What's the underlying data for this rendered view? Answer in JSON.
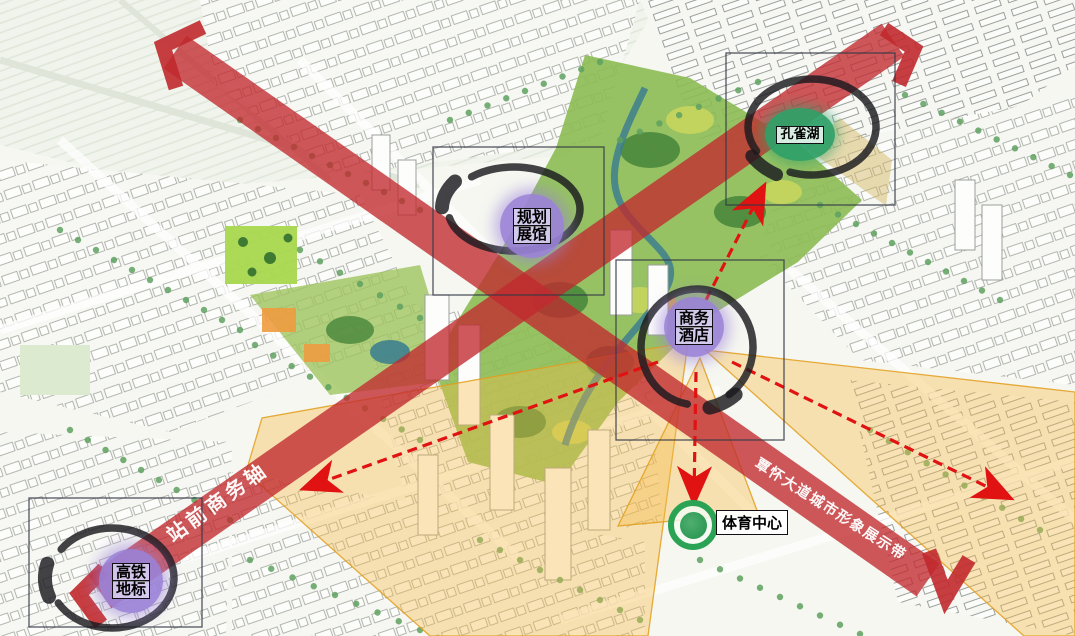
{
  "page": {
    "type": "urban-planning-axis-analysis-map"
  },
  "axes": {
    "business_axis_label": "站前商务轴",
    "display_belt_label": "覃怀大道城市形象展示带"
  },
  "nodes": {
    "peacock_lake": {
      "label": "孔雀湖"
    },
    "planning_hall": {
      "line1": "规划",
      "line2": "展馆"
    },
    "business_hotel": {
      "line1": "商务",
      "line2": "酒店"
    },
    "hsr_landmark": {
      "line1": "高铁",
      "line2": "地标"
    },
    "sports_center": {
      "label": "体育中心"
    }
  },
  "colors": {
    "axis_red": "#c1292e",
    "dashed_arrow_red": "#e01212",
    "view_cone_yellow": "#f5ba46",
    "cone_border": "#e29e1c",
    "badge_purple": "#9a82d8",
    "badge_green": "#2fa068",
    "sports_ring_green": "#2aa355",
    "swoosh_black": "#1a1a1e",
    "park_green": "#8cbb53",
    "water_teal": "#3e7f8e"
  }
}
